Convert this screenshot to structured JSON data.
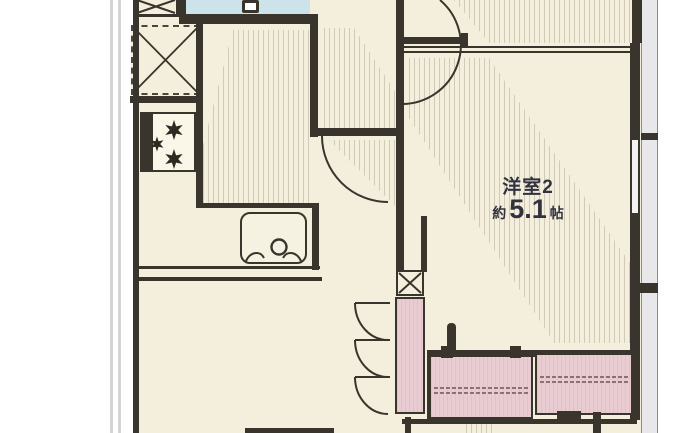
{
  "plan": {
    "room2_label": "洋室2",
    "room2_size_prefix": "約",
    "room2_size_value": "5.1",
    "room2_size_unit": "帖"
  },
  "colors": {
    "wall": "#39352c",
    "floor": "#f4efdd",
    "blue": "#cde3ea",
    "pink": "#e8ccd2",
    "gray": "#e8e8ea",
    "outer": "#d4d4d4",
    "ink": "#32323f"
  }
}
